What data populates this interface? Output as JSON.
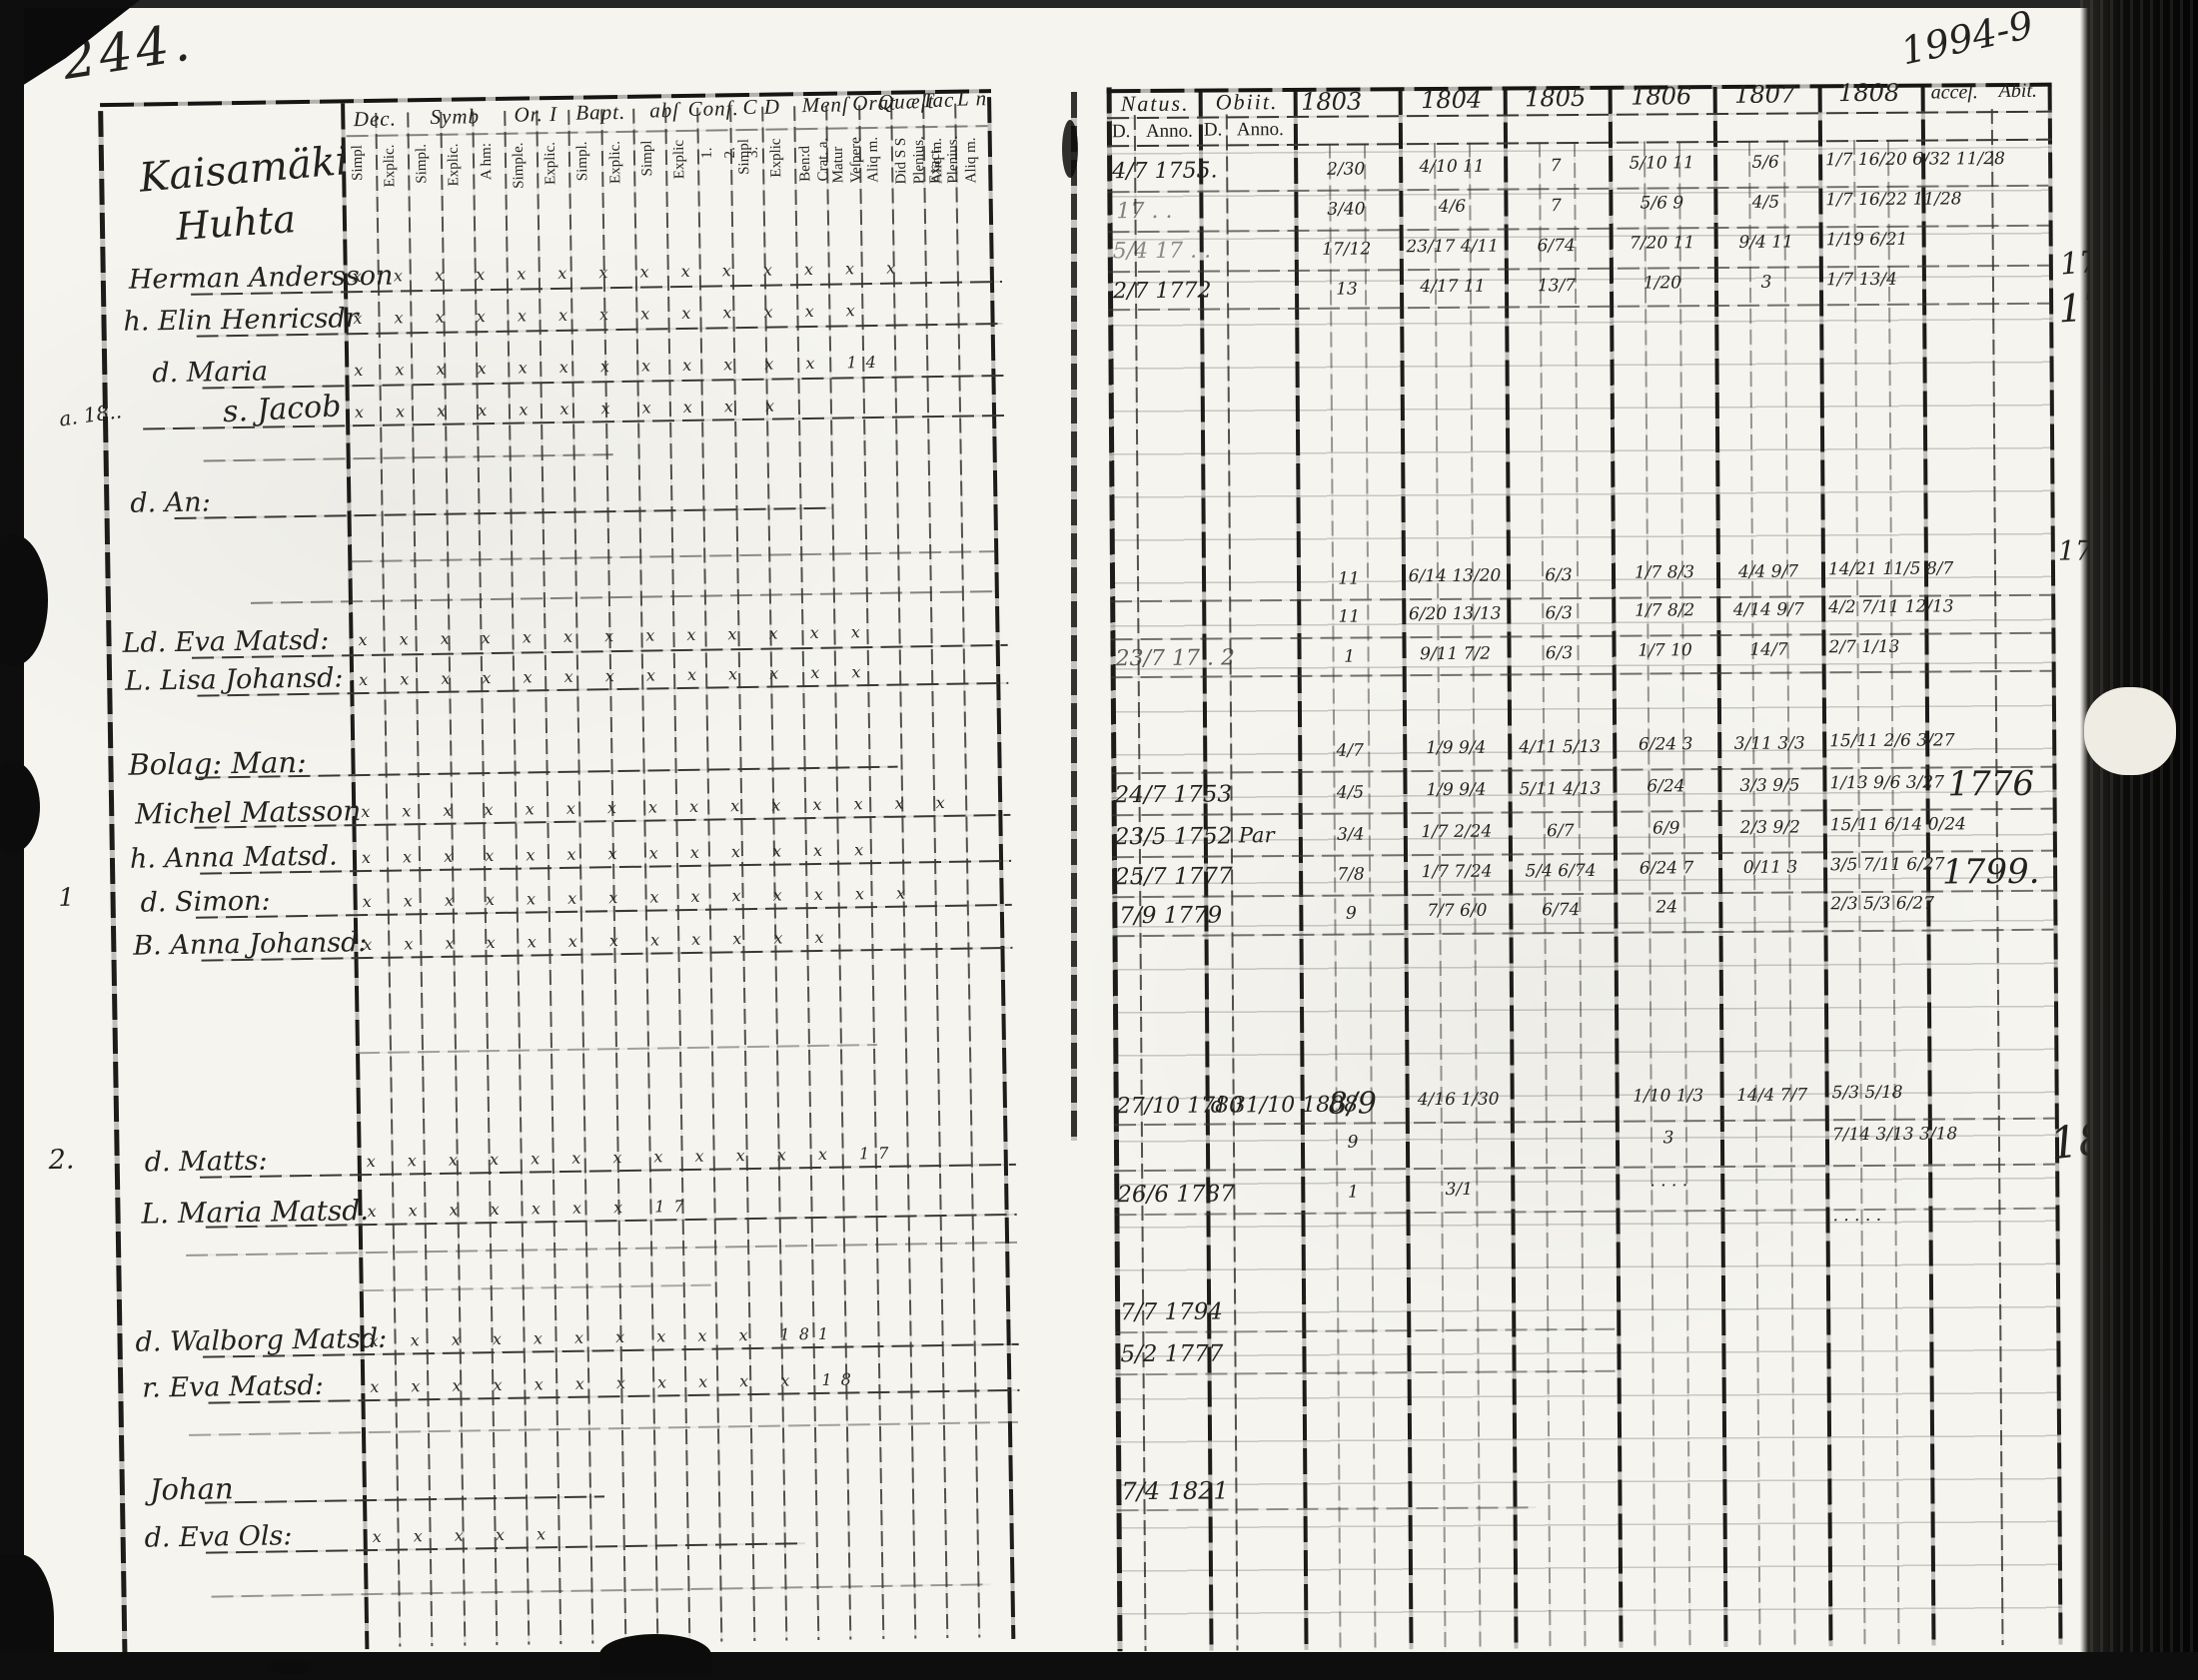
{
  "page": {
    "number_left": "244.",
    "archival_note": "1994-9"
  },
  "left_table": {
    "groups": [
      "Dec.",
      "Symb",
      "Or. I",
      "Bapt.",
      "abſ",
      "Conf.",
      "C D",
      "Menſ",
      "Orat",
      "Quæſt",
      "Tac",
      "L n"
    ],
    "columns": [
      [
        "Simpl"
      ],
      [
        "Explic."
      ],
      [
        "Simpl."
      ],
      [
        "Explic."
      ],
      [
        "A hm:"
      ],
      [
        "Simple."
      ],
      [
        "Explic."
      ],
      [
        "Simpl."
      ],
      [
        "Explic."
      ],
      [
        "Simpl"
      ],
      [
        "Explic"
      ],
      [
        "1.",
        "2.",
        "3."
      ],
      [
        "Simpl"
      ],
      [
        "Explic"
      ],
      [
        "Ben:d",
        "Crat. a."
      ],
      [
        "Matur",
        "Veſpere"
      ],
      [
        "Aliq m."
      ],
      [
        "Did S S",
        "Plenius.",
        "Aliq m."
      ],
      [
        "Exact.",
        "Plenius.",
        "Aliq m."
      ],
      []
    ],
    "village": [
      "Kaisamäki",
      "Huhta"
    ],
    "margin_notes": [
      "a. 18..",
      "1",
      "2."
    ],
    "rows": [
      {
        "name": "Herman Andersson",
        "marks": "x x x x x x x x x x x x x x"
      },
      {
        "name": "h. Elin Henricsdr",
        "marks": "x x x x x x x x x x x x x"
      },
      {
        "name": "d. Maria",
        "marks": "x x x x x x x x x x x x  14"
      },
      {
        "name": "s. Jacob",
        "marks": "x x x x x x x x x x x"
      },
      {
        "name": "d. An:",
        "marks": ""
      },
      {
        "name": "Ld. Eva Matsd:",
        "marks": "x x x x x x x x x x x x x"
      },
      {
        "name": "L. Lisa Johansd:",
        "marks": "x x x x x x x x x x x x x"
      },
      {
        "name": "Bolag: Man:",
        "marks": ""
      },
      {
        "name": "Michel Matsson",
        "marks": "x x x x x x x x x x x x x x x"
      },
      {
        "name": "h. Anna Matsd.",
        "marks": "x x x x x x x x x x x x x"
      },
      {
        "name": "d. Simon:",
        "marks": "x x x x x x x x x x x x x x"
      },
      {
        "name": "B. Anna Johansd:",
        "marks": "x x x x x x x x x x x x"
      },
      {
        "name": "d. Matts:",
        "marks": "x x x x x x x x x x x x  17"
      },
      {
        "name": "L. Maria Matsd.",
        "marks": "x x x x x x x  17"
      },
      {
        "name": "d. Walborg Matsd:",
        "marks": "x x x x x x x x x x  181"
      },
      {
        "name": "r. Eva Matsd:",
        "marks": "x x x x x x x x x x x  18"
      },
      {
        "name": "Johan",
        "marks": ""
      },
      {
        "name": "d. Eva Ols:",
        "marks": "x x x x x"
      }
    ]
  },
  "right_table": {
    "headers": {
      "natus": "Natus.",
      "obiit": "Obiit.",
      "d1": "D.",
      "anno1": "Anno.",
      "d2": "D.",
      "anno2": "Anno.",
      "years": [
        "1803",
        "1804",
        "1805",
        "1806",
        "1807",
        "1808"
      ],
      "acces": "acceſ.",
      "abit": "Abit."
    },
    "rows": [
      {
        "natus": "4/7 1755.",
        "c3": "2/30",
        "c4": "4/10 11",
        "c5": "7",
        "c6": "5/10 11",
        "c7": "5/6",
        "c8": "1/7 16/20 6/32 11/28"
      },
      {
        "natus": "17 . .",
        "c3": "3/40",
        "c4": "4/6",
        "c5": "7",
        "c6": "5/6 9",
        "c7": "4/5",
        "c8": "1/7 16/22 11/28"
      },
      {
        "natus": "5/4 17 . .",
        "c3": "17/12",
        "c4": "23/17 4/11",
        "c5": "6/74",
        "c6": "7/20 11",
        "c7": "9/4 11",
        "c8": "1/19 6/21"
      },
      {
        "natus": "2/7 1772",
        "c3": "13",
        "c4": "4/17 11",
        "c5": "13/7",
        "c6": "1/20",
        "c7": "3",
        "c8": "1/7 13/4"
      },
      {
        "c3": "11",
        "c4": "6/14 13/20",
        "c5": "6/3",
        "c6": "1/7 8/3",
        "c7": "4/4 9/7",
        "c8": "14/21 11/5 8/7"
      },
      {
        "c3": "11",
        "c4": "6/20 13/13",
        "c5": "6/3",
        "c6": "1/7 8/2",
        "c7": "4/14 9/7",
        "c8": "4/2 7/11 12/13"
      },
      {
        "natus": "23/7 17 . 2",
        "c3": "1",
        "c4": "9/11 7/2",
        "c5": "6/3",
        "c6": "1/7 10",
        "c7": "14/7",
        "c8": "2/7 1/13"
      },
      {
        "c3": "4/7",
        "c4": "1/9 9/4",
        "c5": "4/11 5/13",
        "c6": "6/24 3",
        "c7": "3/11 3/3",
        "c8": "15/11 2/6 3/27"
      },
      {
        "natus": "24/7 1753",
        "c3": "4/5",
        "c4": "1/9 9/4",
        "c5": "5/11 4/13",
        "c6": "6/24",
        "c7": "3/3 9/5",
        "c8": "1/13 9/6 3/27",
        "acc": "1776"
      },
      {
        "natus": "23/5 1752",
        "obiit": "Par",
        "c3": "3/4",
        "c4": "1/7 2/24",
        "c5": "6/7",
        "c6": "6/9",
        "c7": "2/3 9/2",
        "c8": "15/11 6/14 0/24"
      },
      {
        "natus": "25/7 1777",
        "c3": "7/8",
        "c4": "1/7 7/24",
        "c5": "5/4 6/74",
        "c6": "6/24 7",
        "c7": "0/11 3",
        "c8": "3/5 7/11 6/27",
        "acc": "1799."
      },
      {
        "natus": "7/9 1779",
        "c3": "9",
        "c4": "7/7 6/0",
        "c5": "6/74",
        "c6": "24",
        "c8": "2/3 5/3 6/27"
      },
      {
        "natus": "27/10 1780",
        "obiit": "d 31/10 1808",
        "c3": "8/9",
        "c4": "4/16 1/30",
        "c6": "1/10 1/3",
        "c7": "14/4 7/7",
        "c8": "5/3 5/18"
      },
      {
        "c3": "9",
        "c6": "3",
        "c8": "7/14 3/13 3/18"
      },
      {
        "natus": "26/6 1787",
        "c3": "1",
        "c4": "3/1",
        "c6": "· · · ·"
      },
      {
        "c8": "· · · · ·"
      },
      {
        "natus": "7/7 1794"
      },
      {
        "natus": "5/2 1777"
      },
      {
        "natus": "7/4 1821"
      }
    ],
    "margin_notes": [
      "1777.",
      "1753.",
      "1754.",
      "1868"
    ]
  }
}
